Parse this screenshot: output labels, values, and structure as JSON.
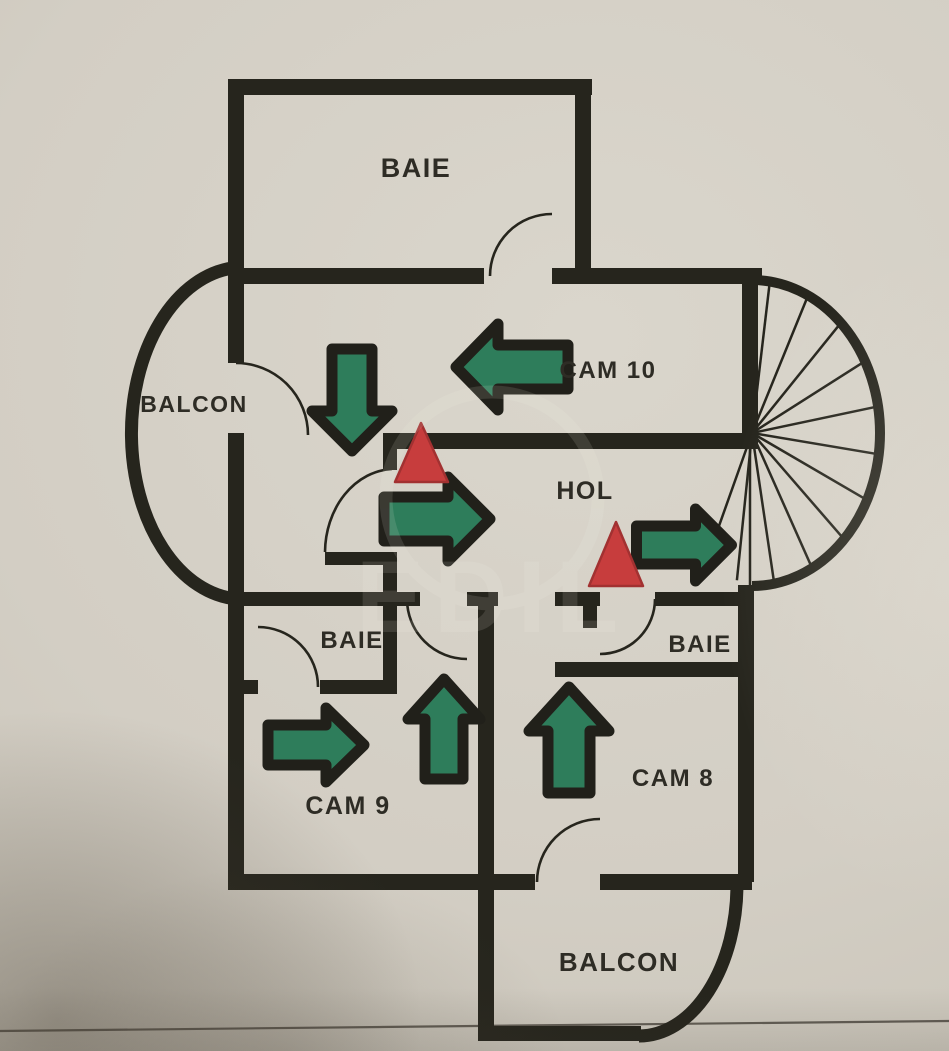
{
  "title": "Evacuation floor plan photo",
  "colors": {
    "paper": "#d3cec4",
    "wall": "#26251d",
    "arrow_outline": "#21201a",
    "green": "#2e7d5b",
    "red": "#c73d3d",
    "red_edge": "#a23131",
    "ink": "#2e2c25",
    "crease": "#46413a",
    "watermark": "#f6f3ea"
  },
  "rooms": [
    {
      "id": "baie-top",
      "label": "BAIE"
    },
    {
      "id": "cam-10",
      "label": "CAM 10"
    },
    {
      "id": "balcon-left",
      "label": "BALCON"
    },
    {
      "id": "hol",
      "label": "HOL"
    },
    {
      "id": "baie-left",
      "label": "BAIE"
    },
    {
      "id": "baie-right",
      "label": "BAIE"
    },
    {
      "id": "cam-9",
      "label": "CAM 9"
    },
    {
      "id": "cam-8",
      "label": "CAM 8"
    },
    {
      "id": "balcon-bottom",
      "label": "BALCON"
    }
  ],
  "watermark": {
    "text": "EDIL"
  },
  "plan": {
    "fold_line": [
      0,
      1031,
      949,
      1021
    ],
    "walls": [
      [
        228,
        79,
        364,
        16
      ],
      [
        228,
        268,
        256,
        16
      ],
      [
        552,
        268,
        210,
        16
      ],
      [
        383,
        433,
        375,
        16
      ],
      [
        325,
        552,
        72,
        13
      ],
      [
        228,
        592,
        192,
        14
      ],
      [
        467,
        592,
        31,
        14
      ],
      [
        555,
        592,
        45,
        14
      ],
      [
        655,
        592,
        97,
        14
      ],
      [
        244,
        680,
        14,
        14
      ],
      [
        320,
        680,
        77,
        14
      ],
      [
        555,
        662,
        197,
        15
      ],
      [
        228,
        874,
        307,
        16
      ],
      [
        600,
        874,
        152,
        16
      ],
      [
        478,
        1026,
        163,
        15
      ],
      [
        228,
        79,
        16,
        284
      ],
      [
        228,
        433,
        16,
        457
      ],
      [
        575,
        79,
        16,
        205
      ],
      [
        742,
        268,
        16,
        173
      ],
      [
        383,
        433,
        14,
        37
      ],
      [
        383,
        553,
        14,
        141
      ],
      [
        478,
        592,
        16,
        449
      ],
      [
        583,
        592,
        14,
        36
      ],
      [
        738,
        585,
        16,
        297
      ]
    ],
    "door_arcs": [
      "M 490 276 A 62 62 0 0 1 552 214",
      "M 236 363 A 72 72 0 0 1 308 435",
      "M 325 552 A 70 84 0 0 1 392 469",
      "M 258 627 A 60 60 0 0 1 318 687",
      "M 407 599 A 60 60 0 0 0 467 659",
      "M 600 654 A 55 55 0 0 0 655 599",
      "M 537 882 A 63 63 0 0 1 600 819"
    ],
    "balcony_arcs": [
      "M 233 268 A 112 166 0 0 0 237 599",
      "M 737 884 A 98 152 0 0 1 639 1036"
    ],
    "stairs": {
      "cx": 752,
      "cy": 433,
      "rx": 128,
      "ry": 153,
      "outline": "M 752 280 A 128 153 0 0 1 752 586",
      "chord": [
        750,
        441,
        750,
        585
      ],
      "spoke_angles": [
        -82,
        -64,
        -46,
        -28,
        -10,
        8,
        26,
        44,
        62,
        80,
        97,
        113
      ]
    },
    "arrows": [
      {
        "id": "cam10-left",
        "dir": "left",
        "cx": 512,
        "cy": 367,
        "len": 112,
        "shaft": 44,
        "head": 86,
        "depth": 42
      },
      {
        "id": "corridor-down",
        "dir": "down",
        "cx": 352,
        "cy": 400,
        "len": 102,
        "shaft": 40,
        "head": 80,
        "depth": 40
      },
      {
        "id": "hol-right",
        "dir": "right",
        "cx": 437,
        "cy": 519,
        "len": 106,
        "shaft": 44,
        "head": 84,
        "depth": 42
      },
      {
        "id": "exit-right",
        "dir": "right",
        "cx": 684,
        "cy": 545,
        "len": 95,
        "shaft": 38,
        "head": 72,
        "depth": 36
      },
      {
        "id": "cam9-right",
        "dir": "right",
        "cx": 316,
        "cy": 745,
        "len": 96,
        "shaft": 40,
        "head": 74,
        "depth": 38
      },
      {
        "id": "cam9-up",
        "dir": "up",
        "cx": 444,
        "cy": 729,
        "len": 100,
        "shaft": 38,
        "head": 72,
        "depth": 40
      },
      {
        "id": "cam8-up",
        "dir": "up",
        "cx": 569,
        "cy": 740,
        "len": 106,
        "shaft": 42,
        "head": 80,
        "depth": 44
      }
    ],
    "triangles": [
      {
        "points": [
          [
            395,
            482
          ],
          [
            448,
            482
          ],
          [
            421,
            423
          ]
        ]
      },
      {
        "points": [
          [
            589,
            586
          ],
          [
            643,
            586
          ],
          [
            616,
            522
          ]
        ]
      }
    ]
  }
}
